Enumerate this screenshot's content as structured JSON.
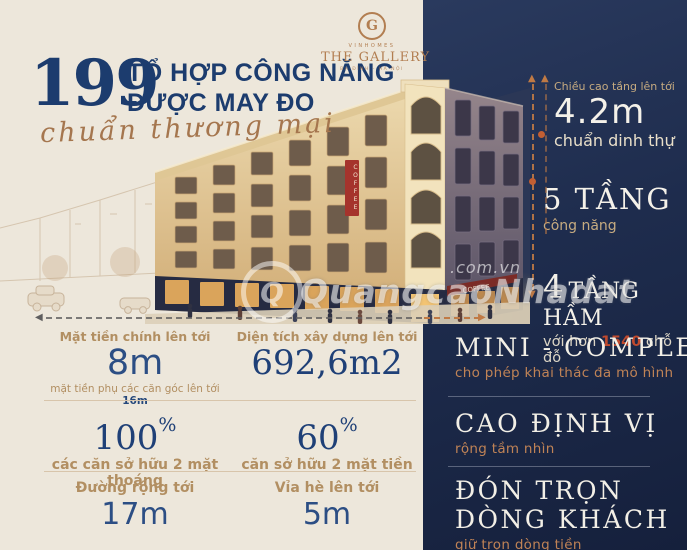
{
  "header": {
    "number": "199",
    "title_line1": "TỔ HỢP CÔNG NĂNG",
    "title_line2": "ĐƯỢC MAY ĐO",
    "script": "chuẩn thương mại"
  },
  "brand": {
    "monogram": "G",
    "name": "VINHOMES",
    "project": "THE GALLERY",
    "location": "BA ĐÌNH - HÀ NỘI"
  },
  "right_panel": {
    "floor_height": {
      "label": "Chiều cao tầng lên tới",
      "value": "4.2m",
      "sub": "chuẩn dinh thự"
    },
    "floors": {
      "value": "5 TẦNG",
      "sub": "công năng"
    },
    "basement": {
      "number": "4",
      "label": "TẦNG HẦM",
      "sub_prefix": "với hơn",
      "sub_value": "1540",
      "sub_suffix": "chỗ đỗ"
    },
    "features": [
      {
        "title": "MINI - COMPLEX",
        "sub": "cho phép khai thác đa mô hình"
      },
      {
        "title": "CAO ĐỊNH VỊ",
        "sub": "rộng tầm nhìn"
      },
      {
        "title_line1": "ĐÓN TRỌN",
        "title_line2": "DÒNG KHÁCH",
        "sub": "giữ trọn dòng tiền"
      }
    ]
  },
  "stats": {
    "row1": [
      {
        "label": "Mặt tiền chính lên tới",
        "value": "8m",
        "sub_prefix": "mặt tiền phụ các căn góc lên tới",
        "sub_value": "16m"
      },
      {
        "label": "Diện tích xây dựng lên tới",
        "value": "692,6m2"
      }
    ],
    "row2": [
      {
        "value": "100",
        "unit": "%",
        "label": "các căn sở hữu 2 mặt thoáng"
      },
      {
        "value": "60",
        "unit": "%",
        "label": "căn sở hữu 2 mặt tiền"
      }
    ],
    "row3": [
      {
        "label": "Đường rộng tới",
        "value": "17m"
      },
      {
        "label": "Vỉa hè lên tới",
        "value": "5m"
      }
    ]
  },
  "building": {
    "sign_vertical": "COFFEE",
    "sign_storefront": "COFFEE"
  },
  "watermark": {
    "monogram": "Q",
    "text": "QuangcaoNhadat",
    "domain": ".com.vn"
  },
  "colors": {
    "cream": "#ede7db",
    "navy": "#1e2c4d",
    "navy_text": "#1c3c6e",
    "tan_label": "#b28f62",
    "copper_logo": "#b27e51",
    "orange_accent": "#c07a45",
    "red_value": "#c04a2e"
  }
}
